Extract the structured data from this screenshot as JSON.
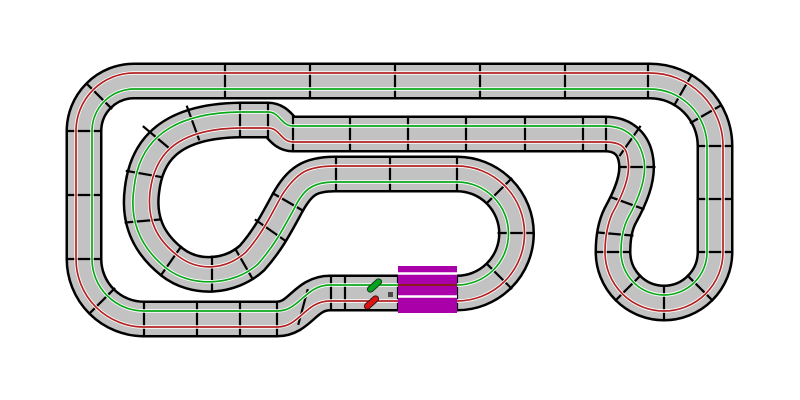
{
  "canvas": {
    "width": 800,
    "height": 400,
    "background_color": "#FFFFFF"
  },
  "track": {
    "border_color": "#000000",
    "border_width": 37,
    "surface_color": "#C2C2C2",
    "surface_width": 32,
    "centerline_path": "M330 293 L457 293 A59.5 59.5 0 1 0 457 174 L335 174 C310 174 300 181 288 202 C276 224 268 240 252 258 C230 278 195 280 172 262 C148 243 138 220 142 190 C146 155 165 121 240 120 L268 120 C280 120 281 134 293 134 L605 134 C625 134 634 146 636 160 C639 178 630 198 620 216 C615 226 613 238 613 252 A51 51 0 1 0 715 252 L715 146 A65 65 0 0 0 650 81 L134 81 A50 50 0 0 0 84 131 L84 259 A60 60 0 0 0 144 319 L277 319 C300 319 305 293 330 293 Z"
  },
  "separators": {
    "color": "#000000",
    "stroke_width": 2.2,
    "length": 37,
    "ticks": [
      [
        225,
        81,
        0
      ],
      [
        310,
        81,
        0
      ],
      [
        395,
        81,
        0
      ],
      [
        480,
        81,
        0
      ],
      [
        565,
        81,
        0
      ],
      [
        648,
        81,
        0
      ],
      [
        683,
        90,
        30
      ],
      [
        706,
        114,
        60
      ],
      [
        715,
        146,
        90
      ],
      [
        715,
        199,
        90
      ],
      [
        715,
        252,
        90
      ],
      [
        700,
        288,
        135
      ],
      [
        664,
        303,
        0
      ],
      [
        628,
        288,
        45
      ],
      [
        613,
        252,
        90
      ],
      [
        615,
        234,
        95
      ],
      [
        627,
        203,
        110
      ],
      [
        637,
        167,
        90
      ],
      [
        630,
        141,
        35
      ],
      [
        606,
        134,
        0
      ],
      [
        583,
        134,
        0
      ],
      [
        525,
        134,
        0
      ],
      [
        466,
        134,
        0
      ],
      [
        408,
        134,
        0
      ],
      [
        350,
        134,
        0
      ],
      [
        293,
        134,
        0
      ],
      [
        268,
        120,
        0
      ],
      [
        240,
        120,
        0
      ],
      [
        193,
        123,
        160
      ],
      [
        157,
        138,
        130
      ],
      [
        144,
        174,
        100
      ],
      [
        143,
        221,
        85
      ],
      [
        171,
        261,
        35
      ],
      [
        212,
        274,
        0
      ],
      [
        244,
        264,
        150
      ],
      [
        270,
        230,
        125
      ],
      [
        288,
        202,
        120
      ],
      [
        336,
        174,
        0
      ],
      [
        390,
        174,
        0
      ],
      [
        457,
        174,
        0
      ],
      [
        499,
        191,
        45
      ],
      [
        516,
        233,
        90
      ],
      [
        499,
        276,
        135
      ],
      [
        457,
        293,
        0
      ],
      [
        398,
        293,
        0
      ],
      [
        345,
        293,
        0
      ],
      [
        331,
        293,
        0
      ],
      [
        303,
        307,
        15
      ],
      [
        277,
        319,
        0
      ],
      [
        240,
        319,
        0
      ],
      [
        197,
        319,
        0
      ],
      [
        144,
        319,
        0
      ],
      [
        102,
        301,
        45
      ],
      [
        84,
        259,
        90
      ],
      [
        84,
        195,
        90
      ],
      [
        84,
        131,
        90
      ],
      [
        99,
        96,
        135
      ]
    ]
  },
  "lanes": {
    "halo_color": "#FFFFFF",
    "halo_width": 3.4,
    "line_width": 1.7,
    "green": {
      "color": "#0CA81C",
      "path": "M330 285 L457 285 A51.5 51.5 0 1 0 457 182 L335 182 C312 182 303 190 294 209 C282 231 274 246 258 264 C234 286 191 288 166 268 C140 247 129 221 134 188 C138 150 160 113 240 112 L268 112 C280 112 281 126 293 126 L605 126 C628 126 640 140 644 160 C647 178 638 200 628 218 C623 228 621 238 621 252 A43 43 0 1 0 707 252 L707 146 A57 57 0 0 0 650 89 L134 89 A42 42 0 0 0 92 131 L92 259 A52 52 0 0 0 144 311 L277 311 C300 311 305 285 330 285 Z"
    },
    "red": {
      "color": "#B22222",
      "path": "M330 301 L457 301 A67.5 67.5 0 1 0 457 166 L335 166 C308 166 297 172 282 195 C270 217 262 234 246 252 C226 270 199 272 178 256 C156 239 147 219 150 192 C154 160 170 129 240 128 L268 128 C280 128 281 142 293 142 L605 142 C622 142 627 148 628 160 C631 176 622 196 612 214 C607 226 605 238 605 252 A59 59 0 1 0 723 252 L723 146 A73 73 0 0 0 650 73 L134 73 A58 58 0 0 0 76 131 L76 259 A68 68 0 0 0 144 327 L277 327 C300 327 305 301 330 301 Z"
    }
  },
  "start_finish": {
    "color": "#AA00AA",
    "x": 398,
    "y": 266,
    "width": 59,
    "height": 47,
    "slot_color": "#FFFFFF",
    "slot_width": 2.6,
    "slot_ys": [
      273.5,
      296.5
    ],
    "center_stripe_color": "#8B1A1A",
    "center_stripe_width": 2,
    "center_stripe_y": 285
  },
  "sensor_dot": {
    "color": "#4A4A4A",
    "x": 388,
    "y": 292,
    "size": 5
  },
  "cars": [
    {
      "id": "green-car",
      "color": "#00A41E",
      "outline_color": "#173A17",
      "x": 374.5,
      "y": 285.5,
      "angle_deg": -42,
      "length": 17,
      "width": 6
    },
    {
      "id": "red-car",
      "color": "#DC1414",
      "outline_color": "#3A1414",
      "x": 371.5,
      "y": 302.5,
      "angle_deg": -42,
      "length": 17,
      "width": 6
    }
  ]
}
